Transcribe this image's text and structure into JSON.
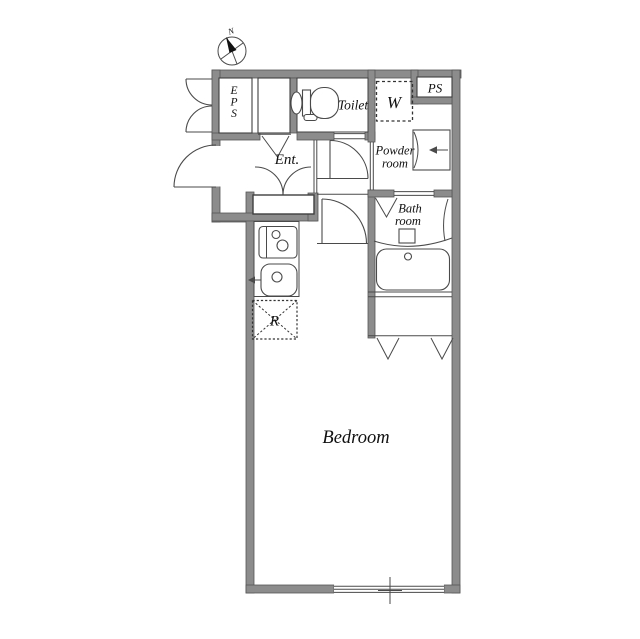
{
  "plan": {
    "type": "apartment-floor-plan",
    "compass": {
      "north_label": "N"
    },
    "rooms": {
      "eps": {
        "letters": [
          "E",
          "P",
          "S"
        ]
      },
      "toilet": {
        "label": "Toilet"
      },
      "washing_machine": {
        "label": "W"
      },
      "pipe_shaft": {
        "label": "PS"
      },
      "powder_room": {
        "label_line1": "Powder",
        "label_line2": "room"
      },
      "entrance": {
        "label": "Ent."
      },
      "bath_room": {
        "label_line1": "Bath",
        "label_line2": "room"
      },
      "refrigerator": {
        "label": "R"
      },
      "bedroom": {
        "label": "Bedroom"
      }
    },
    "colors": {
      "wall_fill": "#8c8c8c",
      "wall_edge": "#565656",
      "line": "#4a4a4a",
      "text": "#111111",
      "background": "#ffffff"
    }
  }
}
